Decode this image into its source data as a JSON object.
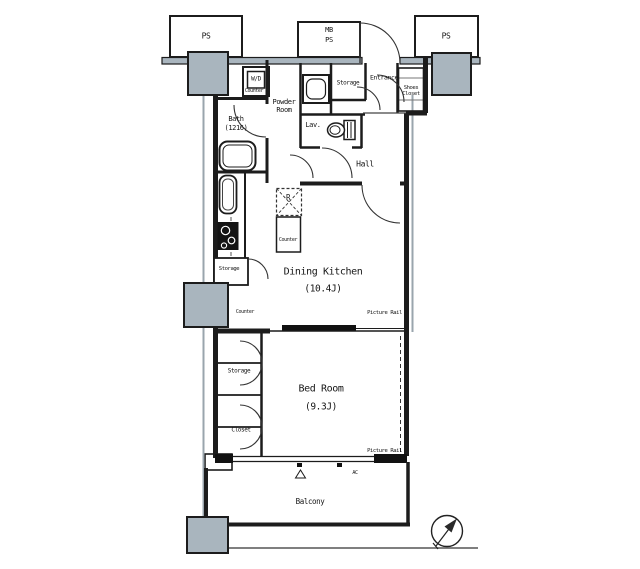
{
  "plan": {
    "pipe_shafts": {
      "ps": "PS",
      "mb": "MB"
    },
    "rooms": {
      "dining_kitchen": {
        "name": "Dining Kitchen",
        "size": "(10.4J)"
      },
      "bed_room": {
        "name": "Bed Room",
        "size": "(9.3J)"
      },
      "bath": {
        "name": "Bath",
        "size": "(1216)"
      },
      "powder_room": "Powder Room",
      "lavatory": "Lav.",
      "hall": "Hall",
      "entrance": "Entrance",
      "balcony": "Balcony",
      "storage_entrance": "Storage",
      "storage_kitchen": "Storage",
      "storage_bedroom": "Storage",
      "closet": "Closet",
      "shoes_closet": "Shoes Closet"
    },
    "fixtures": {
      "washer_dryer": "W/D",
      "refrigerator": "R",
      "counter": "Counter",
      "air_con": "AC",
      "picture_rail": "Picture Rail"
    },
    "colors": {
      "wall": "#1c1c1c",
      "column_fill": "#a9b5be",
      "line_gray": "#9aa5ad"
    }
  }
}
